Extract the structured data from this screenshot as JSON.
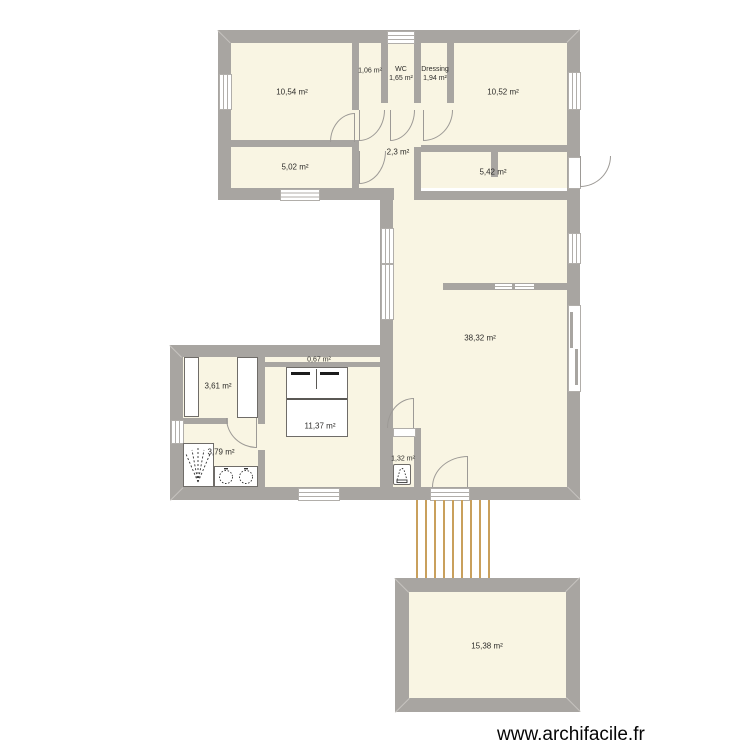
{
  "app": {
    "watermark": "www.archifacile.fr"
  },
  "colors": {
    "wall": "#a8a5a1",
    "room_fill": "#f9f5e3",
    "stairs": "#c9a05c",
    "background": "#ffffff",
    "label_text": "#2e2d2b"
  },
  "rooms": [
    {
      "area": "10,54 m²"
    },
    {
      "area": "1,06 m²"
    },
    {
      "label": "WC",
      "area": "1,65 m²"
    },
    {
      "label": "Dressing",
      "area": "1,94 m²"
    },
    {
      "area": "10,52 m²"
    },
    {
      "area": "5,02 m²"
    },
    {
      "area": "2,3 m²"
    },
    {
      "area": "5,42 m²"
    },
    {
      "area": "38,32 m²"
    },
    {
      "area": "0,67 m²"
    },
    {
      "area": "3,61 m²"
    },
    {
      "area": "11,37 m²"
    },
    {
      "area": "3,79 m²"
    },
    {
      "area": "1,32 m²"
    },
    {
      "area": "15,38 m²"
    }
  ]
}
